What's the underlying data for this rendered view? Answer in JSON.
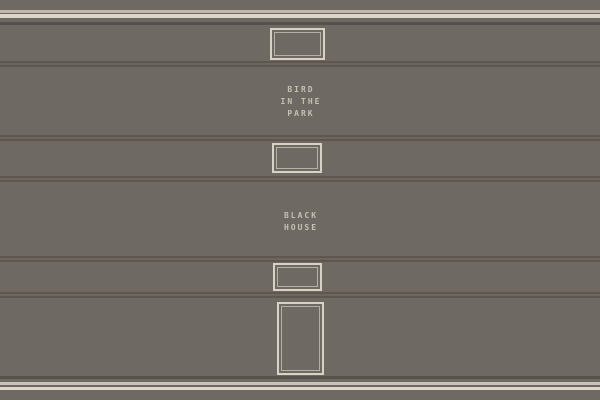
{
  "scene": {
    "description": "stack of book spines with label plates",
    "colors": {
      "background": "#6F6963",
      "trim_light": "#DDD7CA",
      "trim_muted": "#BEB8AD",
      "trim_dark": "#57514B",
      "groove_dark": "#5D574F",
      "groove_mid": "#6C665F",
      "plate_border": "#D8D2C5",
      "plate_inner_border": "#B6B0A4",
      "title_text": "#C6C0B3"
    }
  },
  "titles": {
    "book1": {
      "lines": [
        "BIRD",
        "IN THE",
        "PARK"
      ]
    },
    "book2": {
      "lines": [
        "BLACK",
        "HOUSE"
      ]
    }
  }
}
